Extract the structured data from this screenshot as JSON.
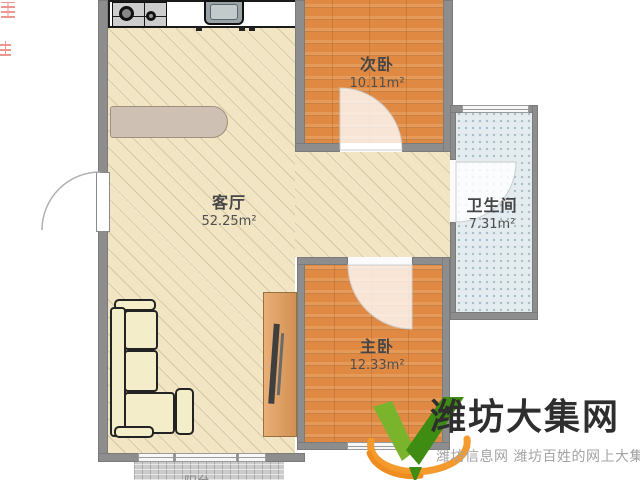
{
  "page": {
    "background": "#ffffff",
    "type": "apartment-floorplan-image"
  },
  "floorplan": {
    "rooms": [
      {
        "name": "客厅",
        "area": "52.25m²"
      },
      {
        "name": "次卧",
        "area": "10.11m²"
      },
      {
        "name": "主卧",
        "area": "12.33m²"
      },
      {
        "name": "卫生间",
        "area": "7.31m²"
      },
      {
        "name": "阳台",
        "area": ""
      }
    ],
    "furniture": [
      "kitchen-counter",
      "gas-stove",
      "sink",
      "bar-counter",
      "l-shaped-sofa",
      "tv-cabinet",
      "tv"
    ],
    "colors": {
      "wall": "#8d8d8d",
      "living_floor": "#f1e5c4",
      "bedroom_floor": "#e08942",
      "bathroom_tile": "#e4ecef",
      "balcony_brick": "#cbcbcb",
      "label_text": "#464646"
    }
  },
  "watermark": {
    "title": "潍坊大集网",
    "subtitle": "潍坊信息网 潍坊百姓的网上大集",
    "logo_icon": "green-v-checkmark-with-orange-swoosh",
    "colors": {
      "green_light": "#7ab32c",
      "green_dark": "#3f8c13",
      "orange": "#f59a2d",
      "title": "#2e2e2e",
      "subtitle": "#a3a3a3"
    }
  }
}
